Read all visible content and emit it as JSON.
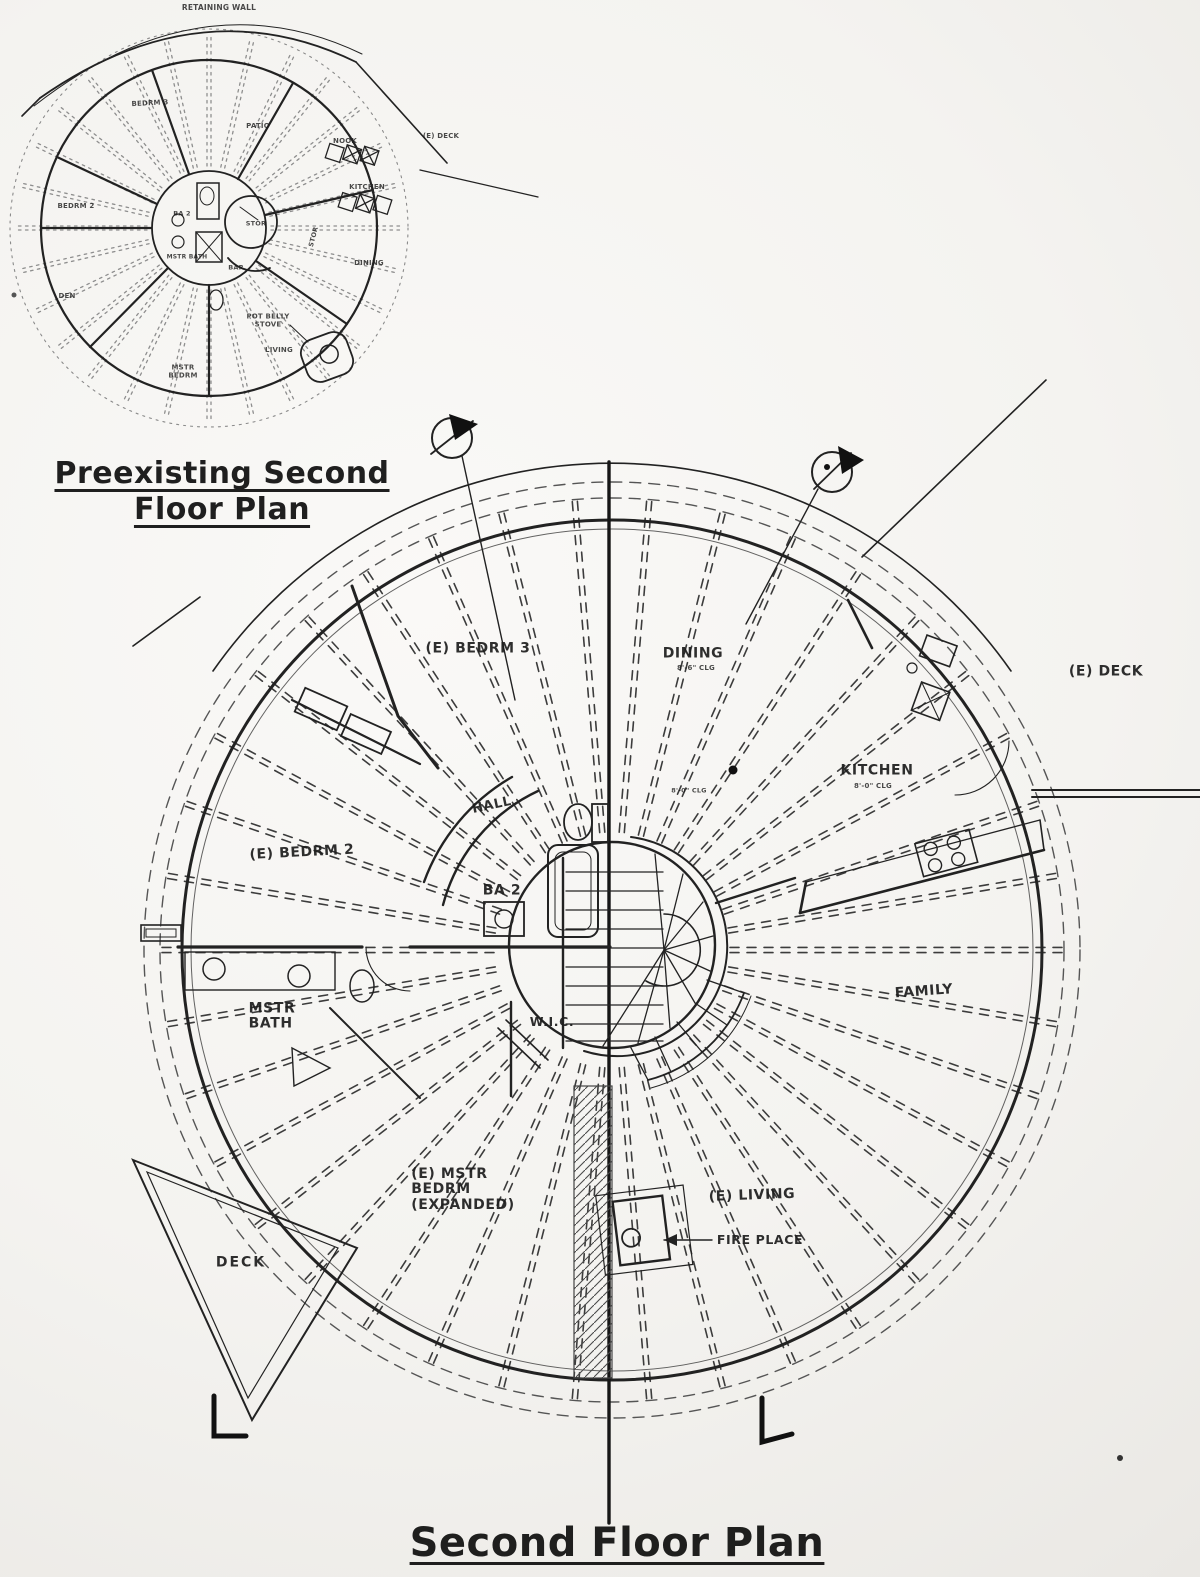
{
  "preexisting_plan": {
    "title": "Preexisting Second\nFloor Plan",
    "labels": {
      "retaining_wall": "RETAINING WALL",
      "bedrm3": "BEDRM 3",
      "patio": "PATIO",
      "nook": "NOOK",
      "deck": "(E) DECK",
      "kitchen": "KITCHEN",
      "bedrm2": "BEDRM 2",
      "ba2": "BA 2",
      "stor_center": "STOR",
      "stor_side": "STOR",
      "dining": "DINING",
      "mstr_bath": "MSTR BATH",
      "bar": "BAR",
      "den": "DEN",
      "pot_belly_stove": "POT BELLY\nSTOVE",
      "living": "LIVING",
      "mstr_bedrm": "MSTR\nBEDRM"
    }
  },
  "second_floor_plan": {
    "title": "Second Floor Plan",
    "labels": {
      "bedrm3": "(E) BEDRM 3",
      "dining": "DINING",
      "dining_clg": "8'-6\" CLG",
      "deck_right": "(E) DECK",
      "kitchen": "KITCHEN",
      "kitchen_clg": "8'-0\" CLG",
      "center_clg": "8'-0\" CLG",
      "hall": "HALL",
      "bedrm2": "(E) BEDRM 2",
      "ba2": "BA 2",
      "mstr_bath": "MSTR\nBATH",
      "wic": "W.I.C.",
      "family": "FAMILY",
      "mstr_bedrm": "(E) MSTR\nBEDRM\n(EXPANDED)",
      "living": "(E) LIVING",
      "fireplace": "FIRE PLACE",
      "deck": "DECK"
    }
  }
}
